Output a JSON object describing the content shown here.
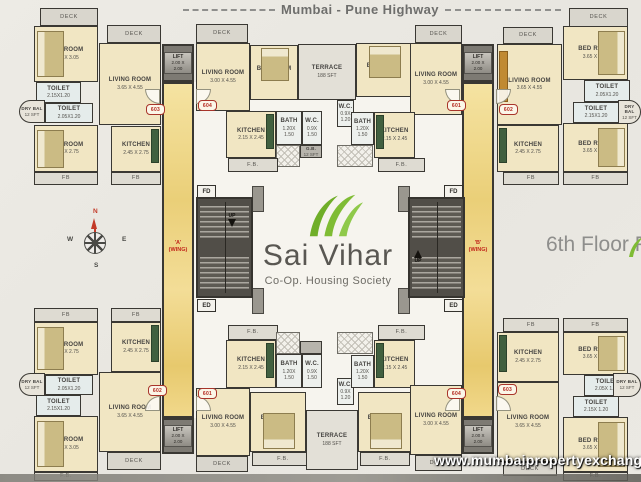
{
  "page": {
    "highway_label": "Mumbai - Pune Highway",
    "floor_label": "6th Floor Plan",
    "watermark": "www.mumbaipropertyexchange.com"
  },
  "logo": {
    "title": "Sai Vihar",
    "subtitle": "Co-Op. Housing Society"
  },
  "compass": {
    "north": "N",
    "south": "S",
    "east": "E",
    "west": "W"
  },
  "core": {
    "lift_label": "LIFT",
    "lift_dims": "2.00 X 2.00",
    "fd_label": "FD",
    "ed_label": "ED",
    "up_label": "UP",
    "wing_a": "'A'",
    "wing_a_sub": "(WING)",
    "wing_b": "'B'",
    "wing_b_sub": "(WING)"
  },
  "colors": {
    "leaf_green": "#76b22e",
    "wing_red": "#c1271b",
    "marble_yellow": "#eed488",
    "room_beige": "#f1e6c3",
    "wall_dark": "#3a3833"
  },
  "plan": {
    "rooms": [
      {
        "n": "a603-deck",
        "t": "deck",
        "l": "DECK",
        "x": 40,
        "y": 8,
        "w": 58,
        "h": 18
      },
      {
        "n": "a603-bedroom-1",
        "t": "room",
        "f": "bed-l",
        "l": "BED ROOM",
        "d": "3.65 X 3.05",
        "x": 34,
        "y": 26,
        "w": 64,
        "h": 56
      },
      {
        "n": "a603-deck-2",
        "t": "deck",
        "l": "DECK",
        "x": 107,
        "y": 25,
        "w": 54,
        "h": 18
      },
      {
        "n": "a603-living-room",
        "t": "room",
        "l": "LIVING ROOM",
        "d": "3.65 X 4.55",
        "x": 99,
        "y": 43,
        "w": 62,
        "h": 82
      },
      {
        "n": "a603-toilet-1",
        "t": "toilet",
        "l": "TOILET",
        "d": "2.15X1.20",
        "x": 36,
        "y": 82,
        "w": 45,
        "h": 21
      },
      {
        "n": "a603-dry-balcony",
        "t": "drybal",
        "r": "l",
        "l": "DRY BAL",
        "d": "12 SFT",
        "x": 19,
        "y": 100,
        "w": 26,
        "h": 23
      },
      {
        "n": "a603-toilet-2",
        "t": "toilet",
        "l": "TOILET",
        "d": "2.05X1.20",
        "x": 45,
        "y": 103,
        "w": 48,
        "h": 20
      },
      {
        "n": "a603-bedroom-2",
        "t": "room",
        "f": "bed-l",
        "l": "BED ROOM",
        "d": "3.65 X 2.75",
        "x": 34,
        "y": 125,
        "w": 64,
        "h": 47
      },
      {
        "n": "a603-kitchen",
        "t": "room",
        "f": "ctr-r",
        "l": "KITCHEN",
        "d": "2.45 X 2.75",
        "x": 111,
        "y": 126,
        "w": 50,
        "h": 46
      },
      {
        "n": "a603-flower-bed-1",
        "t": "fb",
        "l": "FB",
        "x": 34,
        "y": 172,
        "w": 64,
        "h": 13
      },
      {
        "n": "a603-flower-bed-2",
        "t": "fb",
        "l": "FB",
        "x": 111,
        "y": 172,
        "w": 50,
        "h": 13
      },
      {
        "n": "a604-deck",
        "t": "deck",
        "l": "DECK",
        "x": 196,
        "y": 24,
        "w": 52,
        "h": 19
      },
      {
        "n": "a604-living-room",
        "t": "room",
        "l": "LIVING ROOM",
        "d": "3.00 X 4.55",
        "x": 196,
        "y": 43,
        "w": 54,
        "h": 68
      },
      {
        "n": "a604-bedroom",
        "t": "room",
        "f": "bed-t",
        "l": "BED ROOM",
        "d": "3.00 X 3.00",
        "x": 250,
        "y": 45,
        "w": 48,
        "h": 55
      },
      {
        "n": "a604-kitchen",
        "t": "room",
        "f": "ctr-r",
        "l": "KITCHEN",
        "d": "2.15 X 2.45",
        "x": 226,
        "y": 111,
        "w": 50,
        "h": 47
      },
      {
        "n": "a604-bath",
        "t": "bath",
        "l": "BATH",
        "d": "1.20X 1.50",
        "x": 276,
        "y": 111,
        "w": 26,
        "h": 34
      },
      {
        "n": "a604-wc",
        "t": "bath",
        "l": "W.C.",
        "d": "0.9X 1.50",
        "x": 302,
        "y": 111,
        "w": 20,
        "h": 34
      },
      {
        "n": "a604-hatch",
        "t": "hatch",
        "x": 276,
        "y": 145,
        "w": 24,
        "h": 22
      },
      {
        "n": "a604-garbage-duct",
        "t": "duct",
        "l": "G.B.",
        "d": "12 SFT",
        "x": 300,
        "y": 145,
        "w": 22,
        "h": 13
      },
      {
        "n": "a604-flower-bed",
        "t": "fb",
        "l": "F.B.",
        "x": 228,
        "y": 158,
        "w": 50,
        "h": 14
      },
      {
        "n": "top-terrace",
        "t": "terrace",
        "l": "TERRACE",
        "d": "188 SFT",
        "x": 298,
        "y": 44,
        "w": 58,
        "h": 56
      },
      {
        "n": "b601-wc",
        "t": "bath",
        "l": "W.C.",
        "d": "0.9X 1.20",
        "x": 337,
        "y": 100,
        "w": 17,
        "h": 27
      },
      {
        "n": "b601-bath",
        "t": "bath",
        "l": "BATH",
        "d": "1.20X 1.50",
        "x": 351,
        "y": 112,
        "w": 23,
        "h": 33
      },
      {
        "n": "b601-hatch",
        "t": "hatch",
        "x": 337,
        "y": 145,
        "w": 36,
        "h": 22
      },
      {
        "n": "b601-bedroom",
        "t": "room",
        "f": "bed-t",
        "l": "BED ROOM",
        "d": "3.00 X 3.00",
        "x": 356,
        "y": 43,
        "w": 56,
        "h": 54
      },
      {
        "n": "b601-deck",
        "t": "deck",
        "l": "DECK",
        "x": 415,
        "y": 25,
        "w": 47,
        "h": 18
      },
      {
        "n": "b601-living-room",
        "t": "room",
        "l": "LIVING ROOM",
        "d": "3.00 X 4.55",
        "x": 410,
        "y": 43,
        "w": 52,
        "h": 72
      },
      {
        "n": "b601-kitchen",
        "t": "room",
        "f": "ctr-l",
        "l": "KITCHEN",
        "d": "2.15 X 2.45",
        "x": 374,
        "y": 112,
        "w": 41,
        "h": 46
      },
      {
        "n": "b601-flower-bed",
        "t": "fb",
        "l": "F.B.",
        "x": 378,
        "y": 158,
        "w": 47,
        "h": 14
      },
      {
        "n": "b602-deck",
        "t": "deck",
        "l": "DECK",
        "x": 569,
        "y": 8,
        "w": 59,
        "h": 19
      },
      {
        "n": "b602-deck-2",
        "t": "deck",
        "l": "DECK",
        "x": 503,
        "y": 27,
        "w": 50,
        "h": 17
      },
      {
        "n": "b602-living-room",
        "t": "room",
        "f": "wr-l",
        "l": "LIVING ROOM",
        "d": "3.65 X 4.55",
        "x": 497,
        "y": 44,
        "w": 65,
        "h": 81
      },
      {
        "n": "b602-bedroom-1",
        "t": "room",
        "f": "bed-r",
        "l": "BED ROOM",
        "d": "3.65 X 3.05",
        "x": 563,
        "y": 26,
        "w": 65,
        "h": 54
      },
      {
        "n": "b602-toilet-1",
        "t": "toilet",
        "l": "TOILET",
        "d": "2.05X1.20",
        "x": 584,
        "y": 80,
        "w": 46,
        "h": 22
      },
      {
        "n": "b602-toilet-2",
        "t": "toilet",
        "l": "TOILET",
        "d": "2.15X1.20",
        "x": 573,
        "y": 102,
        "w": 46,
        "h": 21
      },
      {
        "n": "b602-dry-balcony",
        "t": "drybal",
        "r": "r",
        "l": "DRY BAL",
        "d": "12 SFT",
        "x": 618,
        "y": 100,
        "w": 23,
        "h": 24
      },
      {
        "n": "b602-bedroom-2",
        "t": "room",
        "f": "bed-r",
        "l": "BED ROOM",
        "d": "3.65 X 2.75",
        "x": 563,
        "y": 123,
        "w": 65,
        "h": 49
      },
      {
        "n": "b602-kitchen",
        "t": "room",
        "f": "ctr-l",
        "l": "KITCHEN",
        "d": "2.45 X 2.75",
        "x": 497,
        "y": 125,
        "w": 62,
        "h": 47
      },
      {
        "n": "b602-flower-bed-1",
        "t": "fb",
        "l": "FB",
        "x": 503,
        "y": 172,
        "w": 56,
        "h": 13
      },
      {
        "n": "b602-flower-bed-2",
        "t": "fb",
        "l": "FB",
        "x": 563,
        "y": 172,
        "w": 65,
        "h": 13
      },
      {
        "n": "a602-flower-bed-1",
        "t": "fb",
        "l": "FB",
        "x": 34,
        "y": 308,
        "w": 64,
        "h": 14
      },
      {
        "n": "a602-flower-bed-2",
        "t": "fb",
        "l": "FB",
        "x": 111,
        "y": 308,
        "w": 50,
        "h": 14
      },
      {
        "n": "a602-bedroom-2",
        "t": "room",
        "f": "bed-l",
        "l": "BED ROOM",
        "d": "3.65 X 2.75",
        "x": 34,
        "y": 322,
        "w": 64,
        "h": 53
      },
      {
        "n": "a602-kitchen",
        "t": "room",
        "f": "ctr-r",
        "l": "KITCHEN",
        "d": "2.45 X 2.75",
        "x": 111,
        "y": 322,
        "w": 50,
        "h": 50
      },
      {
        "n": "a602-toilet-2",
        "t": "toilet",
        "l": "TOILET",
        "d": "2.05X1.20",
        "x": 45,
        "y": 375,
        "w": 48,
        "h": 20
      },
      {
        "n": "a602-dry-balcony",
        "t": "drybal",
        "r": "l",
        "l": "DRY BAL",
        "d": "12 SFT",
        "x": 19,
        "y": 373,
        "w": 26,
        "h": 23
      },
      {
        "n": "a602-toilet-1",
        "t": "toilet",
        "l": "TOILET",
        "d": "2.15X1.20",
        "x": 36,
        "y": 395,
        "w": 45,
        "h": 21
      },
      {
        "n": "a602-bedroom-1",
        "t": "room",
        "f": "bed-l",
        "l": "BED ROOM",
        "d": "3.65 X 3.05",
        "x": 34,
        "y": 416,
        "w": 64,
        "h": 56
      },
      {
        "n": "a602-living-room",
        "t": "room",
        "l": "LIVING ROOM",
        "d": "3.65 X 4.55",
        "x": 99,
        "y": 372,
        "w": 62,
        "h": 80
      },
      {
        "n": "a602-deck",
        "t": "deck",
        "l": "DECK",
        "x": 107,
        "y": 452,
        "w": 54,
        "h": 18
      },
      {
        "n": "a602-flower-bed-3",
        "t": "fb",
        "l": "F.B.",
        "x": 34,
        "y": 472,
        "w": 64,
        "h": 9
      },
      {
        "n": "a601-flower-bed",
        "t": "fb",
        "l": "F.B.",
        "x": 228,
        "y": 325,
        "w": 50,
        "h": 15
      },
      {
        "n": "a601-kitchen",
        "t": "room",
        "f": "ctr-r",
        "l": "KITCHEN",
        "d": "2.15 X 2.45",
        "x": 226,
        "y": 340,
        "w": 50,
        "h": 48
      },
      {
        "n": "a601-hatch",
        "t": "hatch",
        "x": 276,
        "y": 332,
        "w": 24,
        "h": 22
      },
      {
        "n": "a601-duct",
        "t": "duct",
        "x": 300,
        "y": 341,
        "w": 22,
        "h": 13
      },
      {
        "n": "a601-bath",
        "t": "bath",
        "l": "BATH",
        "d": "1.20X 1.50",
        "x": 276,
        "y": 354,
        "w": 26,
        "h": 34
      },
      {
        "n": "a601-wc",
        "t": "bath",
        "l": "W.C.",
        "d": "0.9X 1.50",
        "x": 302,
        "y": 354,
        "w": 20,
        "h": 34
      },
      {
        "n": "a601-living-room",
        "t": "room",
        "l": "LIVING ROOM",
        "d": "3.00 X 4.55",
        "x": 196,
        "y": 388,
        "w": 54,
        "h": 68
      },
      {
        "n": "a601-bedroom",
        "t": "room",
        "f": "bed-b",
        "l": "BED ROOM",
        "d": "3.00 X 3.00",
        "x": 250,
        "y": 392,
        "w": 56,
        "h": 60
      },
      {
        "n": "a601-deck",
        "t": "deck",
        "l": "DECK",
        "x": 196,
        "y": 456,
        "w": 52,
        "h": 16
      },
      {
        "n": "a601-flower-bed-2",
        "t": "fb",
        "l": "F.B.",
        "x": 252,
        "y": 452,
        "w": 62,
        "h": 14
      },
      {
        "n": "bottom-terrace",
        "t": "terrace",
        "l": "TERRACE",
        "d": "188 SFT",
        "x": 306,
        "y": 410,
        "w": 52,
        "h": 60
      },
      {
        "n": "b604-wc",
        "t": "bath",
        "l": "W.C.",
        "d": "0.9X 1.20",
        "x": 337,
        "y": 378,
        "w": 17,
        "h": 27
      },
      {
        "n": "b604-bath",
        "t": "bath",
        "l": "BATH",
        "d": "1.20X 1.50",
        "x": 351,
        "y": 355,
        "w": 23,
        "h": 33
      },
      {
        "n": "b604-hatch",
        "t": "hatch",
        "x": 337,
        "y": 332,
        "w": 36,
        "h": 22
      },
      {
        "n": "b604-flower-bed",
        "t": "fb",
        "l": "F.B.",
        "x": 378,
        "y": 325,
        "w": 47,
        "h": 15
      },
      {
        "n": "b604-kitchen",
        "t": "room",
        "f": "ctr-l",
        "l": "KITCHEN",
        "d": "2.15 X 2.45",
        "x": 374,
        "y": 340,
        "w": 41,
        "h": 48
      },
      {
        "n": "b604-bedroom",
        "t": "room",
        "f": "bed-b",
        "l": "BED ROOM",
        "d": "3.00 X 3.00",
        "x": 358,
        "y": 392,
        "w": 54,
        "h": 60
      },
      {
        "n": "b604-living-room",
        "t": "room",
        "l": "LIVING ROOM",
        "d": "3.00 X 4.55",
        "x": 410,
        "y": 385,
        "w": 52,
        "h": 70
      },
      {
        "n": "b604-deck",
        "t": "deck",
        "l": "DECK",
        "x": 415,
        "y": 455,
        "w": 47,
        "h": 16
      },
      {
        "n": "b604-flower-bed-2",
        "t": "fb",
        "l": "F.B.",
        "x": 360,
        "y": 452,
        "w": 50,
        "h": 14
      },
      {
        "n": "b603-flower-bed-1",
        "t": "fb",
        "l": "FB",
        "x": 503,
        "y": 318,
        "w": 56,
        "h": 14
      },
      {
        "n": "b603-flower-bed-2",
        "t": "fb",
        "l": "FB",
        "x": 563,
        "y": 318,
        "w": 65,
        "h": 14
      },
      {
        "n": "b603-kitchen",
        "t": "room",
        "f": "ctr-l",
        "l": "KITCHEN",
        "d": "2.45 X 2.75",
        "x": 497,
        "y": 332,
        "w": 62,
        "h": 50
      },
      {
        "n": "b603-bedroom-2",
        "t": "room",
        "f": "bed-r",
        "l": "BED ROOM",
        "d": "3.65 X 2.75",
        "x": 563,
        "y": 332,
        "w": 65,
        "h": 43
      },
      {
        "n": "b603-toilet-1",
        "t": "toilet",
        "l": "TOILET",
        "d": "2.05X 1.20",
        "x": 584,
        "y": 375,
        "w": 46,
        "h": 21
      },
      {
        "n": "b603-dry-balcony",
        "t": "drybal",
        "r": "r",
        "l": "DRY BAL",
        "d": "12 SFT",
        "x": 613,
        "y": 373,
        "w": 28,
        "h": 24
      },
      {
        "n": "b603-toilet-2",
        "t": "toilet",
        "l": "TOILET",
        "d": "2.15X 1.20",
        "x": 573,
        "y": 396,
        "w": 46,
        "h": 21
      },
      {
        "n": "b603-bedroom-1",
        "t": "room",
        "f": "bed-r",
        "l": "BED ROOM",
        "d": "3.65 X 3.05",
        "x": 563,
        "y": 417,
        "w": 65,
        "h": 55
      },
      {
        "n": "b603-living-room",
        "t": "room",
        "l": "LIVING ROOM",
        "d": "3.65 X 4.55",
        "x": 497,
        "y": 382,
        "w": 62,
        "h": 80
      },
      {
        "n": "b603-deck",
        "t": "deck",
        "l": "DECK",
        "x": 503,
        "y": 462,
        "w": 54,
        "h": 14
      },
      {
        "n": "b603-flower-bed-3",
        "t": "fb",
        "l": "F.B.",
        "x": 563,
        "y": 472,
        "w": 65,
        "h": 9
      }
    ],
    "blocks": [
      {
        "x": 252,
        "y": 186,
        "w": 12,
        "h": 26
      },
      {
        "x": 398,
        "y": 186,
        "w": 12,
        "h": 26
      },
      {
        "x": 252,
        "y": 288,
        "w": 12,
        "h": 26
      },
      {
        "x": 398,
        "y": 288,
        "w": 12,
        "h": 26
      }
    ],
    "doors": [
      {
        "x": 145,
        "y": 89,
        "c": "bl"
      },
      {
        "x": 196,
        "y": 89,
        "c": "br"
      },
      {
        "x": 445,
        "y": 89,
        "c": "bl"
      },
      {
        "x": 496,
        "y": 89,
        "c": "br"
      },
      {
        "x": 145,
        "y": 396,
        "c": "tl"
      },
      {
        "x": 196,
        "y": 396,
        "c": "tr"
      },
      {
        "x": 445,
        "y": 396,
        "c": "tl"
      },
      {
        "x": 496,
        "y": 396,
        "c": "tr"
      }
    ],
    "flat_numbers": [
      {
        "no": "603",
        "x": 146,
        "y": 104
      },
      {
        "no": "604",
        "x": 198,
        "y": 100
      },
      {
        "no": "601",
        "x": 447,
        "y": 100
      },
      {
        "no": "602",
        "x": 499,
        "y": 104
      },
      {
        "no": "602",
        "x": 148,
        "y": 385
      },
      {
        "no": "601",
        "x": 198,
        "y": 388
      },
      {
        "no": "604",
        "x": 447,
        "y": 388
      },
      {
        "no": "603",
        "x": 498,
        "y": 384
      }
    ]
  }
}
